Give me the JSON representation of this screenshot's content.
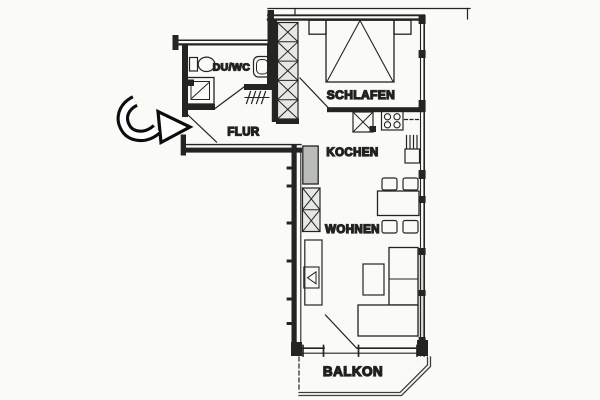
{
  "plan": {
    "type": "apartment-floor-plan",
    "rooms": [
      {
        "id": "du-wc",
        "label": "DU/WC"
      },
      {
        "id": "flur",
        "label": "FLUR"
      },
      {
        "id": "schlafen",
        "label": "SCHLAFEN"
      },
      {
        "id": "kochen",
        "label": "KOCHEN"
      },
      {
        "id": "wohnen",
        "label": "WOHNEN"
      },
      {
        "id": "balkon",
        "label": "BALKON"
      }
    ],
    "icons": {
      "entrance_arrow": "entrance-arrow-icon"
    }
  },
  "colors": {
    "background": "#fafaf7",
    "line": "#242424",
    "label_text": "#161616",
    "closet_fill": "#e6e8e4",
    "cabinet_gray": "#b9bcb8",
    "window_glass": "#d9dbd7",
    "railing": "#3d3d3d"
  }
}
